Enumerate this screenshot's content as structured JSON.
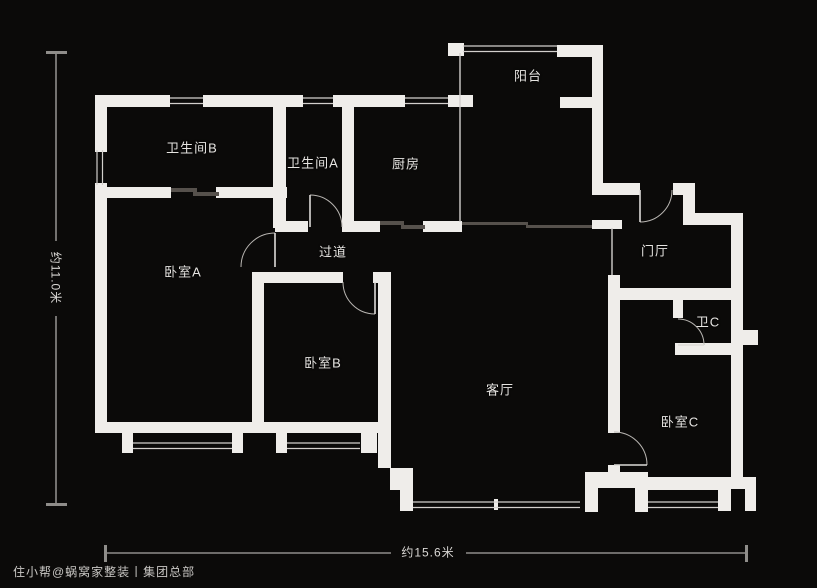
{
  "canvas": {
    "width": 817,
    "height": 588,
    "background": "#0b0a09",
    "wall_color": "#efedea",
    "window_line_color": "#d3d0cd",
    "door_arc_color": "#b9b6b2",
    "door_leaf_color": "#dddbd8",
    "sliding_door_color": "#56514c",
    "dimension_line_color": "#8f8d8a"
  },
  "rooms": [
    {
      "id": "balcony",
      "label": "阳台",
      "x": 528,
      "y": 75
    },
    {
      "id": "bathroom-b",
      "label": "卫生间B",
      "x": 192,
      "y": 147
    },
    {
      "id": "bathroom-a",
      "label": "卫生间A",
      "x": 313,
      "y": 162
    },
    {
      "id": "kitchen",
      "label": "厨房",
      "x": 406,
      "y": 163
    },
    {
      "id": "foyer",
      "label": "门厅",
      "x": 655,
      "y": 250
    },
    {
      "id": "bedroom-a",
      "label": "卧室A",
      "x": 183,
      "y": 271
    },
    {
      "id": "corridor",
      "label": "过道",
      "x": 333,
      "y": 251
    },
    {
      "id": "bathroom-c",
      "label": "卫C",
      "x": 708,
      "y": 321
    },
    {
      "id": "bedroom-b",
      "label": "卧室B",
      "x": 323,
      "y": 362
    },
    {
      "id": "living-room",
      "label": "客厅",
      "x": 500,
      "y": 389
    },
    {
      "id": "bedroom-c",
      "label": "卧室C",
      "x": 680,
      "y": 421
    }
  ],
  "dimensions": {
    "left_label": "约11.0米",
    "bottom_label": "约15.6米"
  },
  "watermark": "住小帮@蜗窝家整装丨集团总部",
  "geometry": {
    "walls": [
      [
        95,
        95,
        75,
        12
      ],
      [
        203,
        95,
        100,
        12
      ],
      [
        333,
        95,
        72,
        12
      ],
      [
        448,
        95,
        25,
        12
      ],
      [
        95,
        95,
        12,
        57
      ],
      [
        95,
        183,
        12,
        250
      ],
      [
        95,
        187,
        76,
        11
      ],
      [
        216,
        187,
        71,
        11
      ],
      [
        273,
        95,
        13,
        133
      ],
      [
        275,
        221,
        33,
        11
      ],
      [
        342,
        95,
        12,
        137
      ],
      [
        342,
        221,
        38,
        11
      ],
      [
        423,
        221,
        39,
        11
      ],
      [
        448,
        43,
        16,
        13
      ],
      [
        557,
        45,
        46,
        12
      ],
      [
        592,
        45,
        11,
        142
      ],
      [
        560,
        97,
        32,
        11
      ],
      [
        592,
        183,
        48,
        12
      ],
      [
        673,
        183,
        22,
        12
      ],
      [
        683,
        195,
        12,
        30
      ],
      [
        695,
        213,
        48,
        12
      ],
      [
        731,
        225,
        12,
        254
      ],
      [
        743,
        330,
        15,
        15
      ],
      [
        592,
        220,
        30,
        9
      ],
      [
        611,
        288,
        124,
        12
      ],
      [
        673,
        300,
        10,
        18
      ],
      [
        675,
        343,
        58,
        12
      ],
      [
        608,
        275,
        12,
        158
      ],
      [
        608,
        465,
        12,
        14
      ],
      [
        252,
        272,
        12,
        161
      ],
      [
        258,
        272,
        85,
        11
      ],
      [
        373,
        272,
        18,
        11
      ],
      [
        378,
        272,
        13,
        196
      ],
      [
        95,
        422,
        295,
        11
      ],
      [
        122,
        433,
        11,
        20
      ],
      [
        232,
        433,
        11,
        20
      ],
      [
        276,
        433,
        11,
        20
      ],
      [
        361,
        433,
        16,
        20
      ],
      [
        390,
        468,
        23,
        22
      ],
      [
        400,
        490,
        13,
        21
      ],
      [
        585,
        472,
        63,
        40
      ],
      [
        642,
        477,
        76,
        13
      ],
      [
        718,
        477,
        38,
        34
      ],
      [
        494,
        499,
        4,
        11
      ]
    ],
    "notches": [
      [
        598,
        488,
        37,
        24
      ],
      [
        731,
        489,
        14,
        22
      ]
    ],
    "windows_h": [
      [
        170,
        97,
        33
      ],
      [
        303,
        97,
        30
      ],
      [
        405,
        97,
        43
      ],
      [
        463,
        45,
        94
      ],
      [
        133,
        442,
        99
      ],
      [
        287,
        442,
        73
      ],
      [
        413,
        501,
        167
      ],
      [
        648,
        501,
        70
      ]
    ],
    "windows_v": [
      [
        96,
        150,
        35
      ]
    ],
    "glass_lines_v": [
      [
        460,
        53,
        169
      ],
      [
        612,
        228,
        47
      ]
    ],
    "sliding_panels": [
      [
        171,
        188,
        26,
        4
      ],
      [
        193,
        192,
        26,
        4
      ],
      [
        380,
        221,
        24,
        4
      ],
      [
        401,
        225,
        24,
        4
      ],
      [
        462,
        222,
        66,
        3
      ],
      [
        526,
        225,
        66,
        3
      ]
    ],
    "doors": [
      {
        "arc": "M310,195 A32,32 0 0 1 342,227",
        "leaf": [
          310,
          195,
          310,
          227
        ]
      },
      {
        "arc": "M241,267 A34,34 0 0 1 275,233",
        "leaf": [
          275,
          233,
          275,
          267
        ]
      },
      {
        "arc": "M343,282 A32,32 0 0 0 375,314",
        "leaf": [
          375,
          282,
          375,
          314
        ]
      },
      {
        "arc": "M672,190 A32,32 0 0 1 640,222",
        "leaf": [
          640,
          190,
          640,
          222
        ]
      },
      {
        "arc": "M678,319 A26,26 0 0 1 704,345",
        "leaf": [
          678,
          345,
          704,
          345
        ]
      },
      {
        "arc": "M614,432 A33,33 0 0 1 647,465",
        "leaf": [
          614,
          465,
          647,
          465
        ]
      }
    ],
    "dim_left": {
      "segs": [
        [
          56,
          52,
          56,
          241
        ],
        [
          56,
          316,
          56,
          505
        ]
      ],
      "caps": [
        [
          46,
          51,
          21,
          3
        ],
        [
          46,
          503,
          21,
          3
        ]
      ]
    },
    "dim_bottom": {
      "segs": [
        [
          106,
          553,
          391,
          553
        ],
        [
          466,
          553,
          747,
          553
        ]
      ],
      "caps": [
        [
          104,
          545,
          3,
          17
        ],
        [
          745,
          545,
          3,
          17
        ]
      ]
    }
  }
}
